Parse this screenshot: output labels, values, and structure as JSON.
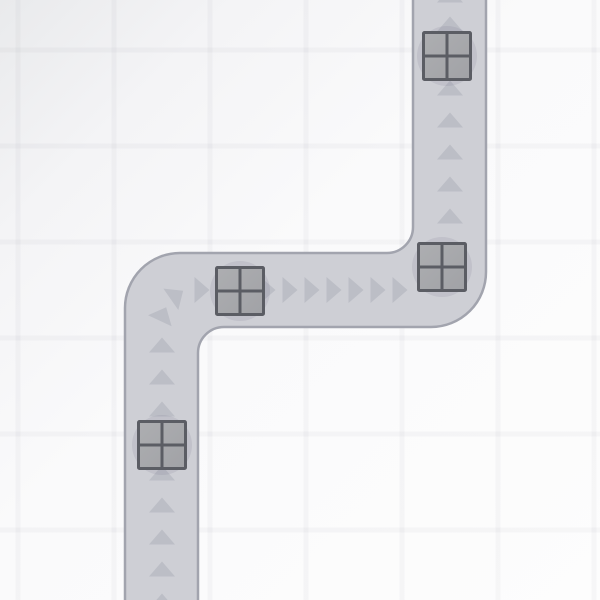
{
  "board": {
    "width": 600,
    "height": 600,
    "grid": {
      "cell": 96,
      "line_width": 5,
      "v_offset": 18,
      "h_offset": 50
    },
    "road": {
      "stroke_width": 2.5,
      "outline": "M 125,610 L 125,308 A 55 55 0 0 1 180,253 L 387,253 A 26 26 0 0 0 413,227 L 413,-10 L 486,-10 L 486,272 A 55 55 0 0 1 431,327 L 224,327 A 26 26 0 0 0 198,353 L 198,610 Z"
    },
    "arrow_shape": {
      "half_base": 13,
      "height": 15
    },
    "arrows": [
      {
        "x": 450,
        "y": -5,
        "a": 0
      },
      {
        "x": 450,
        "y": 24,
        "a": 0
      },
      {
        "x": 450,
        "y": 56,
        "a": 0
      },
      {
        "x": 450,
        "y": 88,
        "a": 0
      },
      {
        "x": 450,
        "y": 120,
        "a": 0
      },
      {
        "x": 450,
        "y": 152,
        "a": 0
      },
      {
        "x": 450,
        "y": 184,
        "a": 0
      },
      {
        "x": 450,
        "y": 216,
        "a": 0
      },
      {
        "x": 202,
        "y": 290,
        "a": 90
      },
      {
        "x": 224,
        "y": 290,
        "a": 90
      },
      {
        "x": 246,
        "y": 290,
        "a": 90
      },
      {
        "x": 268,
        "y": 290,
        "a": 90
      },
      {
        "x": 290,
        "y": 290,
        "a": 90
      },
      {
        "x": 312,
        "y": 290,
        "a": 90
      },
      {
        "x": 334,
        "y": 290,
        "a": 90
      },
      {
        "x": 356,
        "y": 290,
        "a": 90
      },
      {
        "x": 378,
        "y": 290,
        "a": 90
      },
      {
        "x": 400,
        "y": 290,
        "a": 90
      },
      {
        "x": 177,
        "y": 295,
        "a": 55
      },
      {
        "x": 163,
        "y": 314,
        "a": 25
      },
      {
        "x": 162,
        "y": 345,
        "a": 0
      },
      {
        "x": 162,
        "y": 377,
        "a": 0
      },
      {
        "x": 162,
        "y": 409,
        "a": 0
      },
      {
        "x": 162,
        "y": 441,
        "a": 0
      },
      {
        "x": 162,
        "y": 473,
        "a": 0
      },
      {
        "x": 162,
        "y": 505,
        "a": 0
      },
      {
        "x": 162,
        "y": 537,
        "a": 0
      },
      {
        "x": 162,
        "y": 569,
        "a": 0
      },
      {
        "x": 162,
        "y": 601,
        "a": 0
      }
    ],
    "crates": {
      "size": 47,
      "border_width": 3,
      "corner_radius": 1,
      "shadow_radius": 30,
      "items": [
        {
          "x": 447,
          "y": 56
        },
        {
          "x": 442,
          "y": 267
        },
        {
          "x": 240,
          "y": 291
        },
        {
          "x": 162,
          "y": 445
        }
      ]
    }
  },
  "colors": {
    "bg_stops": [
      {
        "offset": 0,
        "color": "#e9eaec"
      },
      {
        "offset": 0.2,
        "color": "#f4f4f6"
      },
      {
        "offset": 0.45,
        "color": "#fafafb"
      },
      {
        "offset": 1,
        "color": "#fdfdfd"
      }
    ],
    "grid_line": "rgba(125,130,150,0.055)",
    "road_fill": "#cecfd5",
    "road_border": "#a2a4ae",
    "arrow": "#bcbec6",
    "crate_fill_light": "#adaeb1",
    "crate_fill_dark": "#a1a2a6",
    "crate_border": "#5b5d64",
    "crate_shadow": "rgba(95,99,122,0.12)"
  }
}
